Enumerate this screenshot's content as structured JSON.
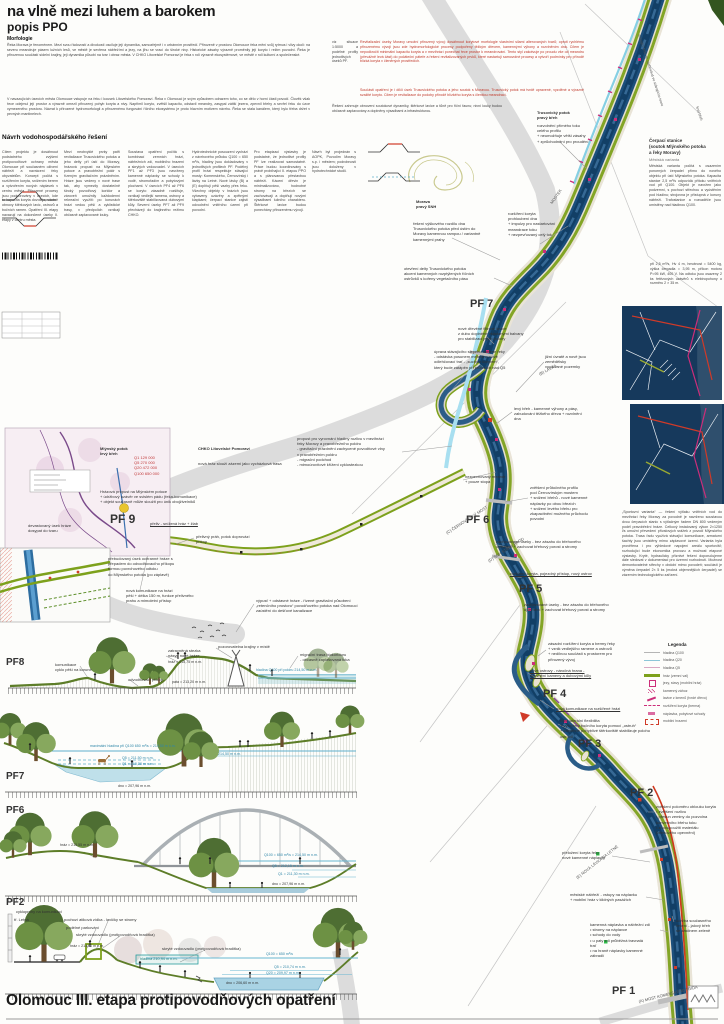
{
  "title": "na vlně mezi luhem a barokem",
  "subtitle": "popis PPO",
  "footer_title": "Olomouc III. etapa protipovodňových opatření",
  "sections": {
    "morfologie": {
      "heading": "Morfologie",
      "p1": "Řeka Morava je fenoménem. Mezi svou řádovostí a divokostí osciluje její dynamika, samozřejmě i v urbánním prostředí. Přirozeně v prostoru Olomouce řeka mění svůj rytmus i vlivy okolí: na severu meandruje pásem lužních lesů, ve městě je sevřena nábřežími a jezy, na jihu se vrací do široké nivy. Historické zásahy výrazně proměnily její koryto i režim povodní. Řeka je přirozenou součástí sídelní krajiny, její dynamika působí na tvar i obraz města. V CHKO Litovelské Pomoraví je řeka v roli výrazně ekosystémové, ve městě v roli kulturní a společenské.",
      "p2": "V navazujících úsecích města Olomouce vstupuje na řeku i kousek Litovelského Pomoraví. Řeka v Olomouci je svým způsobem odrazem toho, co se dělo v horní části povodí. Člověk však řece odejmul její prostor a výrazně omezil přirozený pohyb koryta a nivy. Napřímil koryto, zvětšil kapacitu, odstavil meandry, zasypal zátiší jezera, zpevnil břehy a sevřel řeku do úzce vymezeného prostoru. Návrat k přirozené hydromorfologii a přirozenému fungování říčního ekosystému je proto hlavním motivem návrhu. Řeka se stala kanálem, který bylo třeba držet v pevných mantinelech."
    },
    "navrh": {
      "heading": "Návrh vodohospodářského řešení",
      "cols": [
        "Cílem projektu je dosáhnout podstatného zvýšení protipovodňové ochrany města Olomouce při současném oživení nábřeží a navrácení řeky obyvatelům. Koncept počítá s rozšířením koryta, snížením berem a vytvořením nových náplavek v centru města. Přirozené procesy jsou podporovány v úsecích, kde to kapacita koryta dovoluje, včetně obnovy štěrkových lavic, ostrovů a bočních ramen. Opatření III. etapy navazují na dokončené úseky II. etapy v centru města.",
        "Mezi neobvyklé prvky patří revitalizace Trusovického potoka a jeho delty při ústí do Moravy, hrázová propust na Mlýnském potoce a pravobřežní poldr s řízeným gravitačním prázdněním. Hráze jsou vedeny v nové trase tak, aby vymezily dostatečně široký povodňový koridor a zároveň umožnily každodenní rekreační využití: po korunách hrází vedou pěší a cyklistické trasy, v předpolích vznikají občasně zaplavované louky.",
        "Soustava opatření počítá s kombinací zemních hrází, nábřežních zdí, mobilního hrazení a skrytých vzdouvadel. V úsecích PF1 až PF3 jsou navrženy kamenné náplavky se schody k vodě, stromořadím a pobytovými plochami. V úsecích PF4 až PF6 se koryto zásadně rozšiřuje, vznikají vedlejší ramena, ostrovy a štěrkoviště stabilizovaná dubovými kůly. Severní úseky PF7 až PF9 přecházejí do krajinného režimu CHKO.",
        "Hydrotechnické posouzení vychází z návrhového průtoku Q100 = 650 m³/s, hladiny jsou dokladovány v jednotlivých profilech PF. Podélný profil hrází respektuje stávající mosty: Komenského, Černovírský i lávky na Letné. Nové lávky (B) a (E) doplňují pěší vazby přes řeku. Všechny objekty v hrázích jsou vybaveny uzávěry a zpětnými klapkami; čerpací stanice zajistí odvodnění vnitřního území při povodni.",
        "Pro etapizaci výstavby je podstatné, že jednotlivé profily PF lze realizovat samostatně. Práce budou koordinovány s právě probíhající II. etapou PPO a s plánovanou přestavbou nábřeží. Kácení dřevin je minimalizováno, hodnotné stromy na březích se zachovávají a doplňují novými výsadbami lužního charakteru. Štěrkové lavice budou ponechány přirozenému vývoji.",
        "Návrh byl projednán s AOPK, Povodím Moravy s.p. i městem; podrobnosti jsou doloženy v hydrotechnické studii.",
        "viz situace 1:5000 a podélné profily jednotlivých úseků PF."
      ]
    },
    "upozorneni": {
      "red1": "Revitalizační úseky Moravy umožní přirozený vývoj: dosáhnout korytové morfologie vlastními silami alterovaných tvarů; oproti rychlému přirozenému vývoji jsou zde hydromorfologické procesy podpořeny těžkým dřevem, kamennými výhony a rozvlněním dna. Cílem je nepodkročit minimální kapacitu koryta a v mezihrází ponechat řece prostor k meandrování. Tento styl zakotvuje po proudu vše od meandru (převážně levá část) do počáteční páteře a řešení revitalizovaných prvků, které nastartují samovolné procesy a vytvoří podmínky pro přírodě blízká koryta v členěných prostředích.",
      "red2": "Součástí opatření je i dílčí úsek Trusovického potoka a jeho soutok s Moravou. Trusovický potok má tvrdě upravené, vyzděné a výrazně svažité koryto. Cílem je revitalizace do podoby přírodě blízkého koryta s členitou meandrací.",
      "black": "Řešení zahrnuje obnovení soutokové dynamiky, štěrkové lavice a tůně pro říční faunu; nivní louky budou občasně zaplavovány a doplněny výsadbami a infrastrukturou."
    },
    "cerpaci": {
      "heading": "Čerpací stanice\n(soutok Mlýnského potoka\na řeky Moravy)",
      "sub": "Městská varianta",
      "body": "Městská varianta počítá s osazením ponorných čerpadel přímo do nového objektu při ústí Mlýnského potoka. Kapacita stanice 2,5 m³/s odpovídá přítoku vnitřních vod při Q100. Objekt je navržen jako podzemní, s pochozí střechou a vyústěním pod hladinu; strojovna je přístupná z koruny nábřeží. Trafostanice a rozvaděče jsou umístěny nad hladinou Q100.",
      "body2": "při 2,5 m³/s, Hv 4 m, hmotnost = 5400 kg, výška čerpadla = 3,95 m, příkon motoru P=95 kW, 400 V. Na odtoku jsou osazeny 2 ks řetězových uzávěrů s elektropohony o rozměru 2 × 35 m.",
      "sport": "„Sportovní varianta“ — řešení výtlaku vnitřních vod do mezihrází řeky Moravy za povodně je navrženo soustavou dvou čerpacích stanic s výtlačným řadem DN 800 vedeným podél pravobřežní hráze. Celkový instalovaný výkon 2×1250 l/s umožní převedení přívalových srážek z povodí Mlýnského potoka. Trasa řadu využívá stávající komunikace, armaturní šachty jsou umístěny mimo záplavové území. Varianta byla prověřena i pro výhledové napojení areálu sportovišť; rozhodující bude ekonomika provozu a možnost etapové výstavby. Kryté, hydraulicky příznivé řešení doporučujeme dále sledovat v dokumentaci pro územní rozhodnutí. Možnost demontovatelné střechy v období mimo povodeň; součástí je výměna čerpadel 2× 5 ks (mokrá objemnějších čerpadel) se zázemím technologického zařízení."
    }
  },
  "legend": {
    "title": "Legenda",
    "items": [
      {
        "sym": "line-grey",
        "label": "hladina Q100"
      },
      {
        "sym": "line-blue",
        "label": "hladina Q20"
      },
      {
        "sym": "line-pink",
        "label": "hladina Q5"
      },
      {
        "sym": "line-olive",
        "label": "hráz (zemní val)"
      },
      {
        "sym": "jez",
        "label": "jezy, stavy (mobilní hráz)"
      },
      {
        "sym": "zahoz",
        "label": "kamenný zához"
      },
      {
        "sym": "lavice",
        "label": "lavice z kmenů (tvrdé dřevo)"
      },
      {
        "sym": "berma",
        "label": "rozšíření koryta (berma)"
      },
      {
        "sym": "naplavka",
        "label": "náplavka, pobytové schody"
      },
      {
        "sym": "mobil",
        "label": "mobilní hrazení"
      }
    ]
  },
  "annotations": [
    {
      "n": "label-trusovicky-potok",
      "t": "Trusovický potok\npravý břeh",
      "x": 537,
      "y": 110,
      "w": 52,
      "b": 1
    },
    {
      "t": "rozvolnění přímého toku\ncelého profilu\n+ neumožňuje větší zásahy\n+ zprůchodnění pro proudění",
      "x": 537,
      "y": 123,
      "w": 62
    },
    {
      "n": "label-morava",
      "t": "Morava\npravý SNH",
      "x": 416,
      "y": 199,
      "w": 40,
      "b": 1
    },
    {
      "t": "řešení výškového rozdílu dna Trusovického potoka před ústím do Moravy kamennou rampou / variantně kamennými prahy",
      "x": 413,
      "y": 221,
      "w": 74
    },
    {
      "t": "rozšíření koryta\nprohloubení dna\n+ impulzy pro nastartování\nmeandrace toku\n+ nezpevňovaný celý tok",
      "x": 508,
      "y": 211,
      "w": 62
    },
    {
      "t": "MOSTEK",
      "x": 549,
      "y": 202,
      "r": -55,
      "s": 4,
      "c": "#555",
      "w": 30
    },
    {
      "t": "otevření delty Trusovického potoka\nakcent kamenných rozptýlených říčních\nostrůvků s kořeny vegetačního pásu",
      "x": 404,
      "y": 266,
      "w": 92
    },
    {
      "n": "pf-label-7",
      "t": "PF 7",
      "x": 470,
      "y": 297,
      "s": 11,
      "b": 1,
      "w": 40
    },
    {
      "t": "nové dřevěné filtrové lavice\nz dubu doplněné vkládanými balvany\npro stabilizaci jejich polohy",
      "x": 458,
      "y": 326,
      "w": 68
    },
    {
      "t": "úprava stávajícího slepého ramene řeky\n- odstávka posunem meandru, nově\nodlehčovací trať - „suchým korytem“,\nkterý bude zatápěn při průtocích nad Q5",
      "x": 434,
      "y": 349,
      "w": 74
    },
    {
      "t": "jižní úvratě a nově jsou zemědělsky\nvyužívané pozemky",
      "x": 545,
      "y": 354,
      "w": 58
    },
    {
      "t": "(B) LÁVKA",
      "x": 538,
      "y": 372,
      "r": -28,
      "s": 4,
      "c": "#555",
      "w": 28
    },
    {
      "t": "levý břeh - kamenné výhony a pásy,\nzabudování těžkého dřeva + rozvlnění\ndna",
      "x": 514,
      "y": 406,
      "w": 72
    },
    {
      "t": "propust pro vyrovnání hladiny rozlivu v mezihrází\nřeky Moravy a pravobřežního poldru\n- gravitační prázdnění zachycené povodňové vlny\n  v pravobřežním poldru\n- migrační podchod\n- mimoúrovňové křížení cyklostezkou",
      "x": 297,
      "y": 436,
      "w": 106
    },
    {
      "t": "nezpevňovaný meandr\n+ pouze stopa",
      "x": 465,
      "y": 474,
      "w": 52
    },
    {
      "n": "pf-label-6",
      "t": "PF 6",
      "x": 466,
      "y": 513,
      "s": 11,
      "b": 1,
      "w": 40
    },
    {
      "t": "(C) ČERNOVÍRSKÝ MOST",
      "x": 445,
      "y": 531,
      "r": -33,
      "s": 4,
      "c": "#555",
      "w": 60
    },
    {
      "t": "zvětšení průtočného profilu\npod Černovírským mostem\n+ snížení břehů - nové kamenné\n  náplavky po obou březích\n+ snížení levého břehu pro\n  zkapacitnění možného průchodu\n  povodní",
      "x": 530,
      "y": 485,
      "w": 68
    },
    {
      "t": "zachovávané úseky - bez zásahu do břehového\nopevnění + zachovat břehový porost a stromy",
      "x": 496,
      "y": 539,
      "w": 94
    },
    {
      "t": "(D) SNH STARÝ BROD",
      "x": 487,
      "y": 559,
      "r": -33,
      "s": 4,
      "c": "#555",
      "w": 52
    },
    {
      "t": "rozšíření koryta, pojezdný přístup, nový ostrov",
      "x": 510,
      "y": 571,
      "w": 90,
      "u": 1
    },
    {
      "n": "pf-label-5",
      "t": "PF 5",
      "x": 519,
      "y": 582,
      "s": 11,
      "b": 1,
      "w": 40
    },
    {
      "t": "zachovávané úseky - bez zásahu do břehového\nopevnění + zachovat břehový porost a stromy",
      "x": 524,
      "y": 602,
      "w": 94
    },
    {
      "t": "zásadní rozšíření koryta a bermy řeky\n+ vznik vedlejšího ramene a ostrovů\n+ nedílnou součástí s prostorem pro\n  přirozený vývoj",
      "x": 548,
      "y": 641,
      "w": 72
    },
    {
      "t": "nové ostrovy - náročná hrana -\nzpevnění kameny a dubovými kůly",
      "x": 530,
      "y": 668,
      "w": 68,
      "u": 1
    },
    {
      "n": "pf-label-4",
      "t": "PF 4",
      "x": 543,
      "y": 687,
      "s": 11,
      "b": 1,
      "w": 40
    },
    {
      "t": "nová komunikace na rozšířené hrázi",
      "x": 556,
      "y": 706,
      "w": 72,
      "u": 1
    },
    {
      "t": "říční laterální flexibilita\n+ vytvoření bočního koryta pomocí „ostruh“\n+ kamenné pohyblivé štěrkoviště stabilizuje polohu ostrovů",
      "x": 560,
      "y": 718,
      "w": 96
    },
    {
      "n": "pf-label-3",
      "t": "PF 3",
      "x": 578,
      "y": 737,
      "s": 11,
      "b": 1,
      "w": 40
    },
    {
      "n": "pf-label-2",
      "t": "PF 2",
      "x": 630,
      "y": 786,
      "s": 11,
      "b": 1,
      "w": 40
    },
    {
      "t": "zvětšení poloměru oblouku koryta\n•  zvětšení rozlivu\n•  přesun zeminy do pozvolna\n   konvexního břehu toku\n•  znovupoužití materiálu\n   (břehového opevnění)",
      "x": 656,
      "y": 804,
      "w": 66
    },
    {
      "t": "přeložení koryta řeky\nnové kamenné náplavky",
      "x": 562,
      "y": 850,
      "w": 52
    },
    {
      "t": "(E) NOVÁ LÁVKA NA LETNÉ",
      "x": 575,
      "y": 876,
      "r": -38,
      "s": 4,
      "c": "#555",
      "w": 62
    },
    {
      "t": "městské nábřeží - vstupy na náplavku\n+ mobilní hráz v klidných pasážích",
      "x": 570,
      "y": 892,
      "w": 78
    },
    {
      "t": "kamenná náplavka a nábřežní zdi\n•  stromy na náplavce\n•  schody do vody\n•  u paty zdi průběžná travnatá\n   trať\n•  na hraně náplavky kamenné\n   zábradlí",
      "x": 590,
      "y": 922,
      "w": 72
    },
    {
      "t": "údržba současného\nřešení - jalový břeh\nse zástinem zeleně",
      "x": 676,
      "y": 918,
      "w": 46
    },
    {
      "n": "pf-label-1",
      "t": "PF 1",
      "x": 612,
      "y": 984,
      "s": 11,
      "b": 1,
      "w": 40
    },
    {
      "t": "(A) MOST KOMENSKÉHO TŘÍDA",
      "x": 638,
      "y": 999,
      "r": -14,
      "s": 4,
      "c": "#555",
      "w": 72
    },
    {
      "n": "label-mlynsky-potok",
      "t": "Mlýnský potok\nlevý břeh",
      "x": 100,
      "y": 446,
      "w": 46,
      "b": 1
    },
    {
      "n": "label-chko",
      "t": "CHKO Litovelské Pomoraví",
      "x": 198,
      "y": 446,
      "w": 82,
      "b": 1
    },
    {
      "t": "Q1      129 000\nQ5      270 000\nQ20    472 000\nQ100  650 000",
      "x": 134,
      "y": 455,
      "w": 50,
      "c": "#c23b3b"
    },
    {
      "t": "nová hráz slouží zázemí jako vycházková trasa",
      "x": 198,
      "y": 461,
      "w": 96
    },
    {
      "t": "Hrázová propust na Mlýnském potoce\n+ údržbový uzávěr ve svislém pádu (řeka-komunikace)\n+ objekt současně může sloužit pro únik obojživelníků",
      "x": 100,
      "y": 489,
      "w": 112
    },
    {
      "n": "pf-label-9",
      "t": "PF 9",
      "x": 110,
      "y": 512,
      "s": 12,
      "b": 1,
      "w": 40
    },
    {
      "t": "přeliv - snížená hráz + žlab",
      "x": 150,
      "y": 521,
      "w": 62,
      "u": 1
    },
    {
      "t": "devastovaný úsek hráze\ndosypat do tvaru",
      "x": 28,
      "y": 523,
      "w": 48
    },
    {
      "t": "přebudovaný úsek ochranné hráze s\npřepadem do odvodňovacího příkopu\nformou povrchového odtoku\ndo Mlýnského potoka (po záplavě)",
      "x": 108,
      "y": 556,
      "w": 74
    },
    {
      "t": "přelivný práh, potok doprovází příkop",
      "x": 196,
      "y": 534,
      "w": 64
    },
    {
      "t": "nová komunikace na hrázi\npěší + délka 150 m, funkce přelivného\nprahu a mimoletní přístup",
      "x": 126,
      "y": 588,
      "w": 68
    },
    {
      "t": "výpusť + odstavné hráze - řízené gravitační působení\n„retenčního prostoru“ povodňového potoka nad Olomoucí\nzaústění do dešťové kanalizace",
      "x": 256,
      "y": 598,
      "w": 112
    },
    {
      "n": "section-label-pf8",
      "t": "PF8",
      "x": 6,
      "y": 656,
      "s": 10,
      "b": 1,
      "w": 30
    },
    {
      "t": "komunikace\ncyklo pěší na koruně",
      "x": 55,
      "y": 662,
      "w": 52
    },
    {
      "t": "odvodňovací příkop",
      "x": 128,
      "y": 677,
      "w": 46
    },
    {
      "t": "zatravněná stezka\nnásyp nové hráze",
      "x": 168,
      "y": 648,
      "w": 46
    },
    {
      "t": "hráz = 215,75 m n.m.",
      "x": 168,
      "y": 660,
      "w": 48,
      "s": 3.6
    },
    {
      "t": "pata = 213,20 m n.m.",
      "x": 172,
      "y": 680,
      "w": 48,
      "s": 3.6
    },
    {
      "t": "pozorovatelna krajiny v místě",
      "x": 218,
      "y": 644,
      "w": 64
    },
    {
      "t": "migrační trasa biokoridoru\n- občasně zaplavovaná luka",
      "x": 300,
      "y": 652,
      "w": 58
    },
    {
      "t": "hladina Q100 při poldru 214,50 m n.m.",
      "x": 256,
      "y": 668,
      "w": 84,
      "c": "#2e86a8",
      "s": 3.6
    },
    {
      "n": "section-label-pf7",
      "t": "PF7",
      "x": 6,
      "y": 770,
      "s": 10,
      "b": 1,
      "w": 30
    },
    {
      "t": "maximální hladina při Q100 650 m³/s = 214,50 m n.m.",
      "x": 90,
      "y": 744,
      "w": 112,
      "c": "#2e86a8",
      "s": 3.6
    },
    {
      "t": "Q5 = 211,50 m n.m.",
      "x": 122,
      "y": 756,
      "w": 46,
      "c": "#2e86a8",
      "s": 3.6
    },
    {
      "t": "Q1 = 210,38 m n.m.",
      "x": 122,
      "y": 762,
      "w": 46,
      "c": "#2e86a8",
      "s": 3.6
    },
    {
      "t": "dno = 207,96 m n.m.",
      "x": 118,
      "y": 784,
      "w": 46,
      "s": 3.6
    },
    {
      "t": "214,50 m n.m.",
      "x": 218,
      "y": 752,
      "w": 34,
      "c": "#2e86a8",
      "s": 3.6
    },
    {
      "n": "section-label-pf6",
      "t": "PF6",
      "x": 6,
      "y": 804,
      "s": 10,
      "b": 1,
      "w": 30
    },
    {
      "t": "hráz = 215,55 m n.m.",
      "x": 60,
      "y": 843,
      "w": 48,
      "s": 3.6
    },
    {
      "t": "Q100 = 650 m³/s = 214,50 m n.m.",
      "x": 264,
      "y": 853,
      "w": 72,
      "c": "#2e86a8",
      "s": 3.6
    },
    {
      "t": "Q5 = 212,15 m n.m.",
      "x": 272,
      "y": 864,
      "w": 46,
      "c": "#2e86a8",
      "s": 3.6
    },
    {
      "t": "Q1 = 211,30 m n.m.",
      "x": 278,
      "y": 872,
      "w": 46,
      "c": "#2e86a8",
      "s": 3.6
    },
    {
      "t": "dno = 207,96 m n.m.",
      "x": 272,
      "y": 882,
      "w": 46,
      "s": 3.6
    },
    {
      "n": "section-label-pf2",
      "t": "PF2",
      "x": 6,
      "y": 896,
      "s": 10,
      "b": 1,
      "w": 30
    },
    {
      "t": "cyklopruhy na komunikaci",
      "x": 16,
      "y": 909,
      "w": 58
    },
    {
      "t": "tř. Letná",
      "x": 14,
      "y": 917,
      "w": 30
    },
    {
      "t": "pochozí atiková zídka - lavičky se stromy",
      "x": 64,
      "y": 917,
      "w": 90
    },
    {
      "t": "podélné parkování",
      "x": 66,
      "y": 925,
      "w": 46
    },
    {
      "t": "skryté vzdouvadlo (protipovodňová hradítka)",
      "x": 76,
      "y": 932,
      "w": 94
    },
    {
      "t": "hráz = 213,80 m n.m.",
      "x": 70,
      "y": 944,
      "w": 48,
      "s": 3.6
    },
    {
      "t": "skryté vzdouvadlo (protipovodňová hradítka)",
      "x": 162,
      "y": 946,
      "w": 94
    },
    {
      "t": "hladina 210,94 m n.m.",
      "x": 140,
      "y": 956.5,
      "w": 56,
      "c": "#1d7d7d",
      "s": 3.8
    },
    {
      "t": "Q100 = 650 m³/s",
      "x": 266,
      "y": 952,
      "w": 42,
      "c": "#2e86a8",
      "s": 3.6
    },
    {
      "t": "Q5 = 210,74 m n.m.",
      "x": 274,
      "y": 965,
      "w": 46,
      "c": "#2e86a8",
      "s": 3.6
    },
    {
      "t": "Q20 = 209,97 m n.m.",
      "x": 266,
      "y": 971,
      "w": 48,
      "c": "#2e86a8",
      "s": 3.6
    },
    {
      "t": "dno = 206,60 m n.m.",
      "x": 226,
      "y": 981,
      "w": 46,
      "s": 3.6
    },
    {
      "t": "stávající hráz se zachovává ve stávajícím tvaru",
      "x": 641,
      "y": 34,
      "r": 72,
      "s": 3.6,
      "c": "#555",
      "w": 92
    },
    {
      "t": "levý břeh",
      "x": 699,
      "y": 106,
      "r": 72,
      "s": 3.6,
      "c": "#555",
      "w": 30
    }
  ],
  "colors": {
    "river": "#1c4f7c",
    "river_core": "#123f66",
    "levee_olive": "#7da11c",
    "berm_tan": "#e6dfcf",
    "marker_magenta": "#cc2e7a",
    "flood_red": "#d03a28",
    "water_cyan": "#86cfe3",
    "old_channel_grey": "#dcdcdc",
    "accent_red_text": "#c0392b",
    "navy_inset": "#16395c"
  }
}
